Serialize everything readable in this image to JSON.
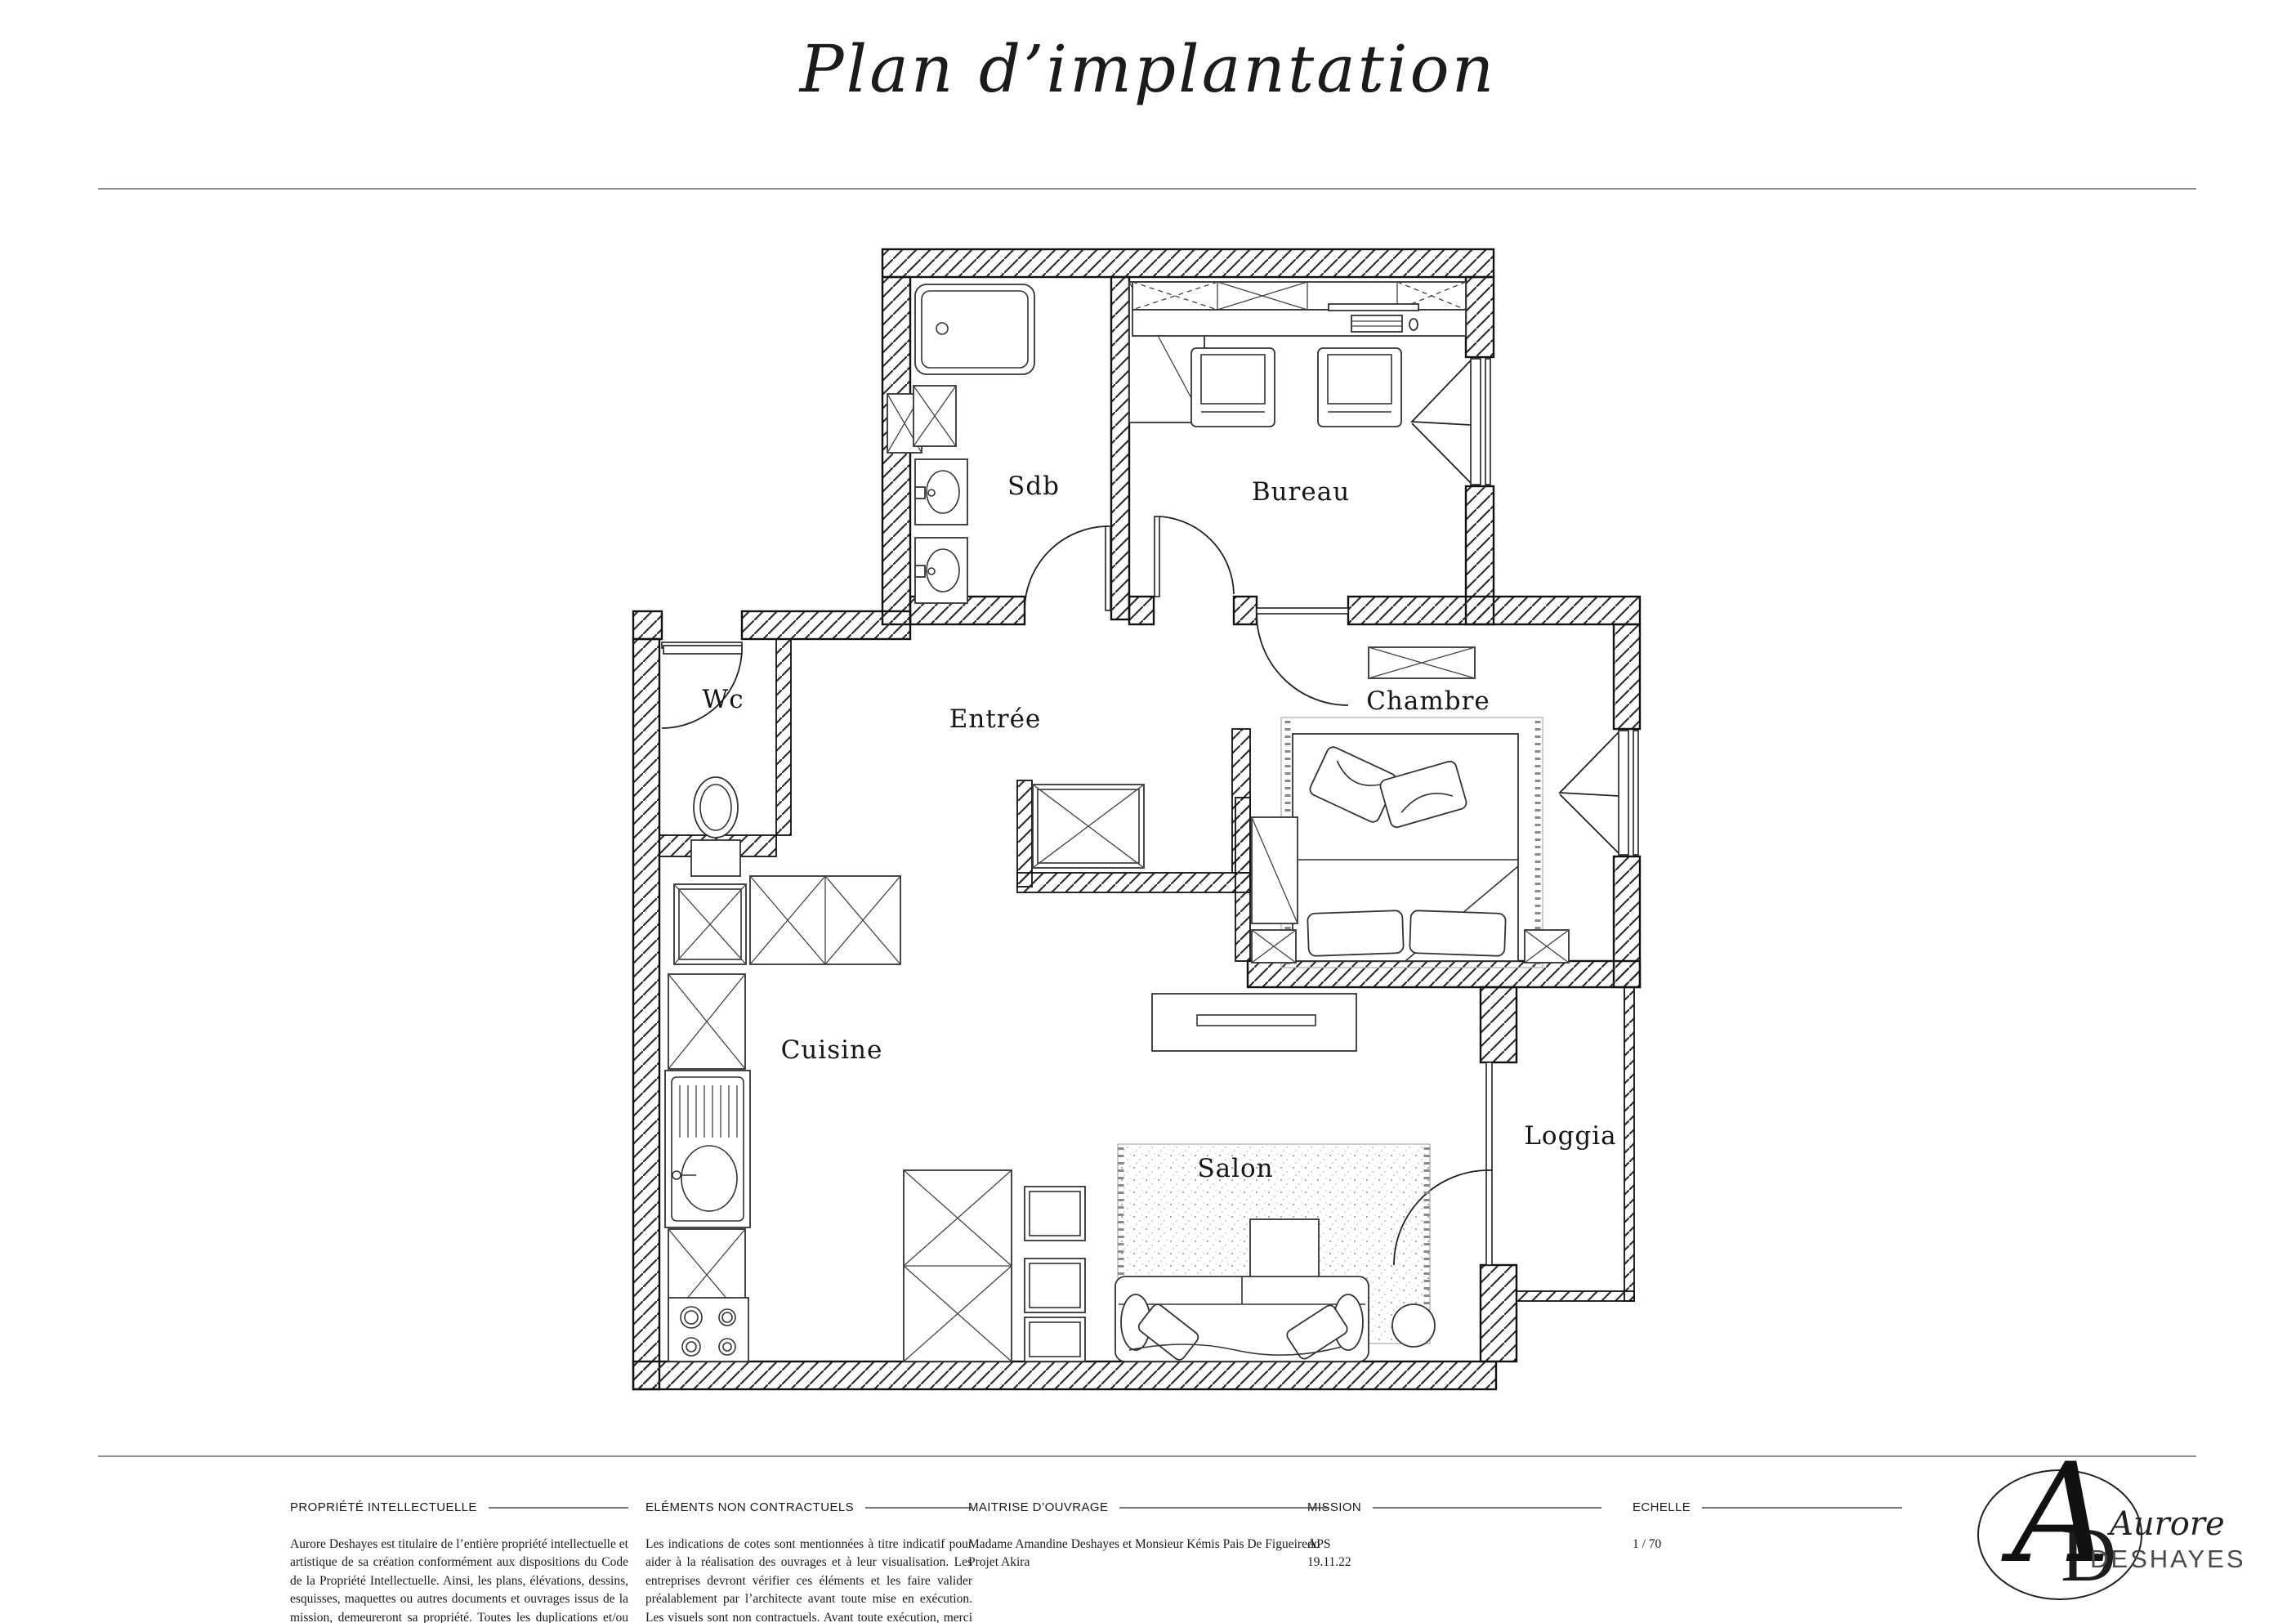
{
  "page": {
    "title": "Plan d’implantation"
  },
  "plan": {
    "rooms": {
      "sdb": "Sdb",
      "bureau": "Bureau",
      "wc": "Wc",
      "entree": "Entrée",
      "chambre": "Chambre",
      "cuisine": "Cuisine",
      "salon": "Salon",
      "loggia": "Loggia"
    }
  },
  "footer": {
    "sections": [
      {
        "heading": "PROPRIÉTÉ INTELLECTUELLE",
        "body": "Aurore Deshayes est titulaire de l’entière propriété intellectuelle et artistique de sa création conformément aux dispositions du Code de la Propriété Intellectuelle. Ainsi, les plans, élévations, dessins, esquisses, maquettes ou autres documents et ouvrages issus de la mission, demeureront sa propriété. Toutes les duplications et/ou modifications ultérieures de cette création ne pourront être réalisées qu’avec l’accord écrit préalable d’Aurore Deshayes."
      },
      {
        "heading": "ELÉMENTS NON CONTRACTUELS",
        "body": "Les indications de cotes sont mentionnées à titre indicatif pour aider à la réalisation des ouvrages et à leur visualisation. Les entreprises devront vérifier ces éléments et les faire valider préalablement par l’architecte avant toute mise en exécution. Les visuels sont non contractuels. Avant toute exécution, merci de se rapporter à l’architecte Aurore Deshayes, pour d’éventuelles modifications."
      },
      {
        "heading": "MAITRISE D’OUVRAGE",
        "body": "Madame Amandine Deshayes et Monsieur Kémis Pais De Figueiredo\nProjet Akira"
      },
      {
        "heading": "MISSION",
        "body": "APS\n19.11.22"
      },
      {
        "heading": "ECHELLE",
        "body": "1 / 70"
      }
    ]
  },
  "logo": {
    "monogram_a": "A",
    "monogram_d": "D",
    "first_name": "Aurore",
    "last_name": "DESHAYES"
  }
}
